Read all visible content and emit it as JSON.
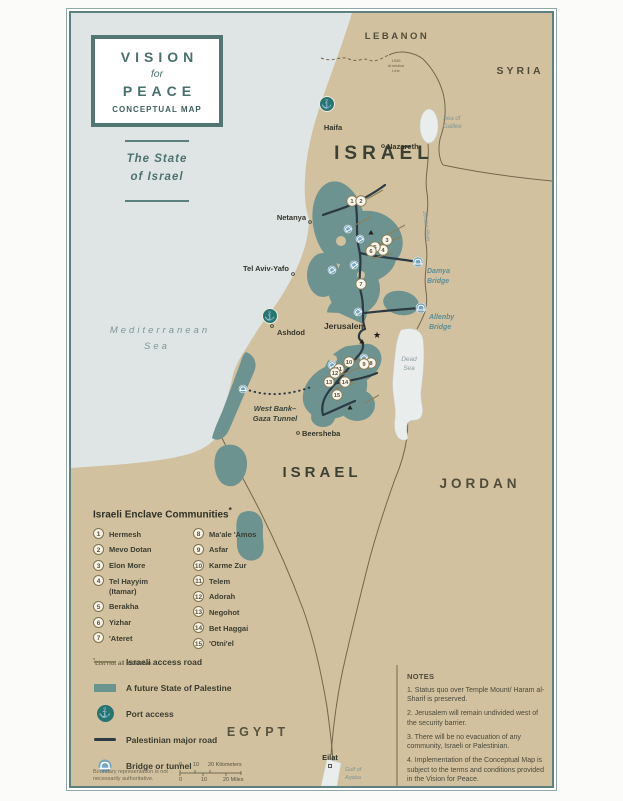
{
  "title_block": {
    "line1": "VISION",
    "line2": "for",
    "line3": "PEACE",
    "line4": "CONCEPTUAL MAP",
    "subtitle_line1": "The State",
    "subtitle_line2": "of Israel"
  },
  "colors": {
    "land": "#d2c19e",
    "sea": "#dfe5e4",
    "palestine_teal": "#6d9390",
    "lake": "#e9eeed",
    "frame_teal": "#5d8180",
    "road_dark": "#2c3a43",
    "access_road_olive": "#8a8058",
    "border_olive": "#73684c",
    "bridge_blue": "#74a6c1",
    "port_teal": "#27756f",
    "label_teal": "#5b8e96"
  },
  "map": {
    "countries": {
      "lebanon": "LEBANON",
      "syria": "SYRIA",
      "israel_north": "ISRAEL",
      "israel_south": "ISRAEL",
      "jordan": "JORDAN",
      "egypt": "EGYPT"
    },
    "water": {
      "med_1": "Mediterranean",
      "med_2": "Sea",
      "galilee_1": "Sea of",
      "galilee_2": "Galilee",
      "dead_1": "Dead",
      "dead_2": "Sea",
      "gulf_1": "Gulf of",
      "gulf_2": "Aqaba",
      "jordan_river": "Jordan River"
    },
    "annotations": {
      "armistice_1": "1949",
      "armistice_2": "Armistice",
      "armistice_3": "Line",
      "damya_1": "Damya",
      "damya_2": "Bridge",
      "allenby_1": "Allenby",
      "allenby_2": "Bridge",
      "tunnel_1": "West Bank–",
      "tunnel_2": "Gaza Tunnel"
    },
    "cities": [
      {
        "name": "Haifa",
        "x": 262,
        "y": 117,
        "anchor": "middle"
      },
      {
        "name": "Nazareth",
        "x": 316,
        "y": 136,
        "anchor": "start",
        "dot": [
          312,
          133
        ]
      },
      {
        "name": "Netanya",
        "x": 235,
        "y": 207,
        "anchor": "end",
        "dot": [
          239,
          209
        ]
      },
      {
        "name": "Tel Aviv-Yafo",
        "x": 218,
        "y": 258,
        "anchor": "end",
        "dot": [
          222,
          261
        ]
      },
      {
        "name": "Ashdod",
        "x": 206,
        "y": 322,
        "anchor": "start",
        "dot": [
          201,
          313
        ]
      },
      {
        "name": "Jerusalem",
        "x": 295,
        "y": 316,
        "anchor": "end",
        "bold": true,
        "star": [
          302,
          325
        ]
      },
      {
        "name": "Beersheba",
        "x": 231,
        "y": 423,
        "anchor": "start",
        "dot": [
          227,
          420
        ]
      },
      {
        "name": "Eilat",
        "x": 259,
        "y": 747,
        "anchor": "middle",
        "dot": [
          259,
          753
        ],
        "sq": true
      }
    ],
    "markers": [
      {
        "n": "1",
        "x": 281,
        "y": 188
      },
      {
        "n": "2",
        "x": 290,
        "y": 188
      },
      {
        "n": "3",
        "x": 316,
        "y": 227
      },
      {
        "n": "4",
        "x": 312,
        "y": 237
      },
      {
        "n": "5",
        "x": 304,
        "y": 234
      },
      {
        "n": "6",
        "x": 300,
        "y": 238
      },
      {
        "n": "7",
        "x": 290,
        "y": 271
      },
      {
        "n": "8",
        "x": 300,
        "y": 350
      },
      {
        "n": "9",
        "x": 293,
        "y": 351
      },
      {
        "n": "10",
        "x": 278,
        "y": 349
      },
      {
        "n": "11",
        "x": 268,
        "y": 356
      },
      {
        "n": "12",
        "x": 264,
        "y": 360
      },
      {
        "n": "13",
        "x": 258,
        "y": 369
      },
      {
        "n": "14",
        "x": 274,
        "y": 369
      },
      {
        "n": "15",
        "x": 266,
        "y": 382
      }
    ],
    "bridge_icons": [
      [
        347,
        249,
        0,
        5
      ],
      [
        350,
        295,
        0,
        5
      ],
      [
        277,
        216,
        -30,
        4
      ],
      [
        289,
        226,
        -30,
        4
      ],
      [
        283,
        252,
        -35,
        4
      ],
      [
        261,
        257,
        -30,
        4
      ],
      [
        287,
        299,
        -35,
        4
      ],
      [
        293,
        345,
        -30,
        4
      ],
      [
        261,
        352,
        -30,
        4
      ],
      [
        172,
        376,
        0,
        4
      ]
    ],
    "ports": [
      [
        256,
        91
      ],
      [
        199,
        303
      ]
    ],
    "strategic_sites": [
      [
        300,
        220
      ],
      [
        291,
        329
      ],
      [
        279,
        395
      ]
    ]
  },
  "enclaves": {
    "title": "Israeli Enclave Communities",
    "title_sup": "*",
    "footnote_sup": "*",
    "footnote": "List not all inclusive.",
    "col1": [
      {
        "n": "1",
        "name": "Hermesh"
      },
      {
        "n": "2",
        "name": "Mevo Dotan"
      },
      {
        "n": "3",
        "name": "Elon More"
      },
      {
        "n": "4",
        "name": "Tel Hayyim",
        "name2": "(Itamar)"
      },
      {
        "n": "5",
        "name": "Berakha"
      },
      {
        "n": "6",
        "name": "Yizhar"
      },
      {
        "n": "7",
        "name": "'Ateret"
      }
    ],
    "col2": [
      {
        "n": "8",
        "name": "Ma'ale 'Amos"
      },
      {
        "n": "9",
        "name": "Asfar"
      },
      {
        "n": "10",
        "name": "Karme Zur"
      },
      {
        "n": "11",
        "name": "Telem"
      },
      {
        "n": "12",
        "name": "Adorah"
      },
      {
        "n": "13",
        "name": "Negohot"
      },
      {
        "n": "14",
        "name": "Bet Haggai"
      },
      {
        "n": "15",
        "name": "'Otni'el"
      }
    ]
  },
  "legend": {
    "items": [
      {
        "label": "Israeli access road"
      },
      {
        "label": "A future State of Palestine"
      },
      {
        "label": "Port access"
      },
      {
        "label": "Palestinian major road"
      },
      {
        "label": "Bridge or tunnel"
      },
      {
        "label": "Strategic site"
      }
    ],
    "port_glyph": "⚓"
  },
  "notes": {
    "title": "NOTES",
    "items": [
      "1. Status quo over Temple Mount/ Haram al-Sharif is preserved.",
      "2. Jerusalem will remain undivided west of the security barrier.",
      "3. There will be no evacuation of any community, Israeli or Palestinian.",
      "4. Implementation of the Conceptual Map is subject to the terms and conditions provided in the Vision for Peace."
    ]
  },
  "scale": {
    "km": [
      "0",
      "10",
      "20 Kilometers"
    ],
    "miles": [
      "0",
      "10",
      "20 Miles"
    ],
    "disclaimer": "Boundary representation is not necessarily authoritative."
  },
  "symbols": {
    "star": "★",
    "anchor": "⚓"
  }
}
